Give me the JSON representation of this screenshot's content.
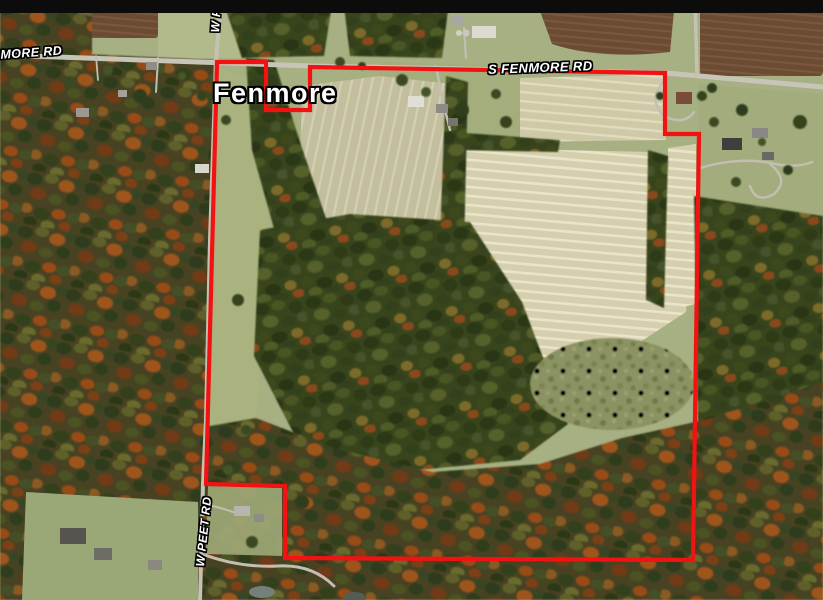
{
  "view": {
    "letterbox_color": "#0c0c0c",
    "kind": "aerial-satellite-parcel-map"
  },
  "map": {
    "town_label": "Fenmore",
    "road_labels": {
      "fenmore_partial": "NMORE RD",
      "peet_top": "W PEET",
      "s_fenmore": "S FENMORE RD",
      "peet_bottom": "W PEET RD"
    },
    "parcel_boundary": {
      "color": "#f21212",
      "stroke_width": 4.2,
      "path": "M 217,62 L 266,62 L 266,110 L 310,110 L 310,67 L 665,73 L 665,134 L 699,134 L 693,560 L 285,558 L 285,486 L 206,484 Z"
    },
    "palette": {
      "boundary_red": "#f21212",
      "road_gray": "#c8c5b8",
      "field_tan_bright": "#d5cfae",
      "field_tan_soft": "#c3bf9e",
      "plowed_brown": "#6b4c33",
      "forest_green": "#39451e",
      "forest_autumn": "#474320",
      "autumn_orange": "#9d541e",
      "lawn_green": "#a3ad7d",
      "label_white": "#ffffff",
      "label_outline": "#000000"
    }
  }
}
